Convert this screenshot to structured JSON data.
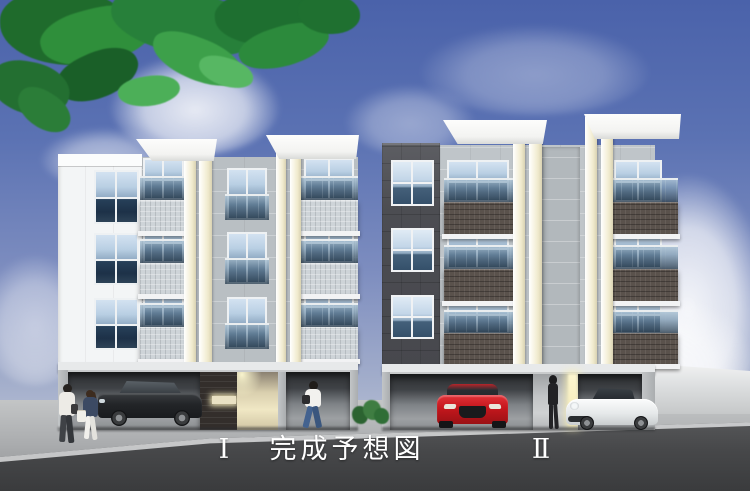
{
  "caption": {
    "building_left_label": "Ⅰ",
    "title": "完成予想図",
    "building_right_label": "Ⅱ"
  },
  "colors": {
    "sky_top": "#4a62aa",
    "sky_horizon": "#ccd2e0",
    "cloud": "#ffffff",
    "foliage_green": "#2a7d37",
    "road_asphalt": "#47484a",
    "sidewalk": "#aeb0b2",
    "caption_text": "#ffffff",
    "building1_facade_white": "#f3f5f6",
    "building1_concrete_gray": "#b9bfc3",
    "building1_balcony_tile": "#ced4d8",
    "building2_facade_dark": "#4c4d52",
    "building2_concrete_gray": "#bfc5c9",
    "building2_balcony_tile": "#5a524c",
    "accent_pillar_cream": "#efe9cc",
    "entrance_glow": "#f0e7c4",
    "window_glass_dark": "#1d3148",
    "window_glass_sky": "#d3e2f1",
    "car_suv_dark": "#232528",
    "car_red": "#c4171d",
    "car_sports_white": "#f0f2f2"
  }
}
